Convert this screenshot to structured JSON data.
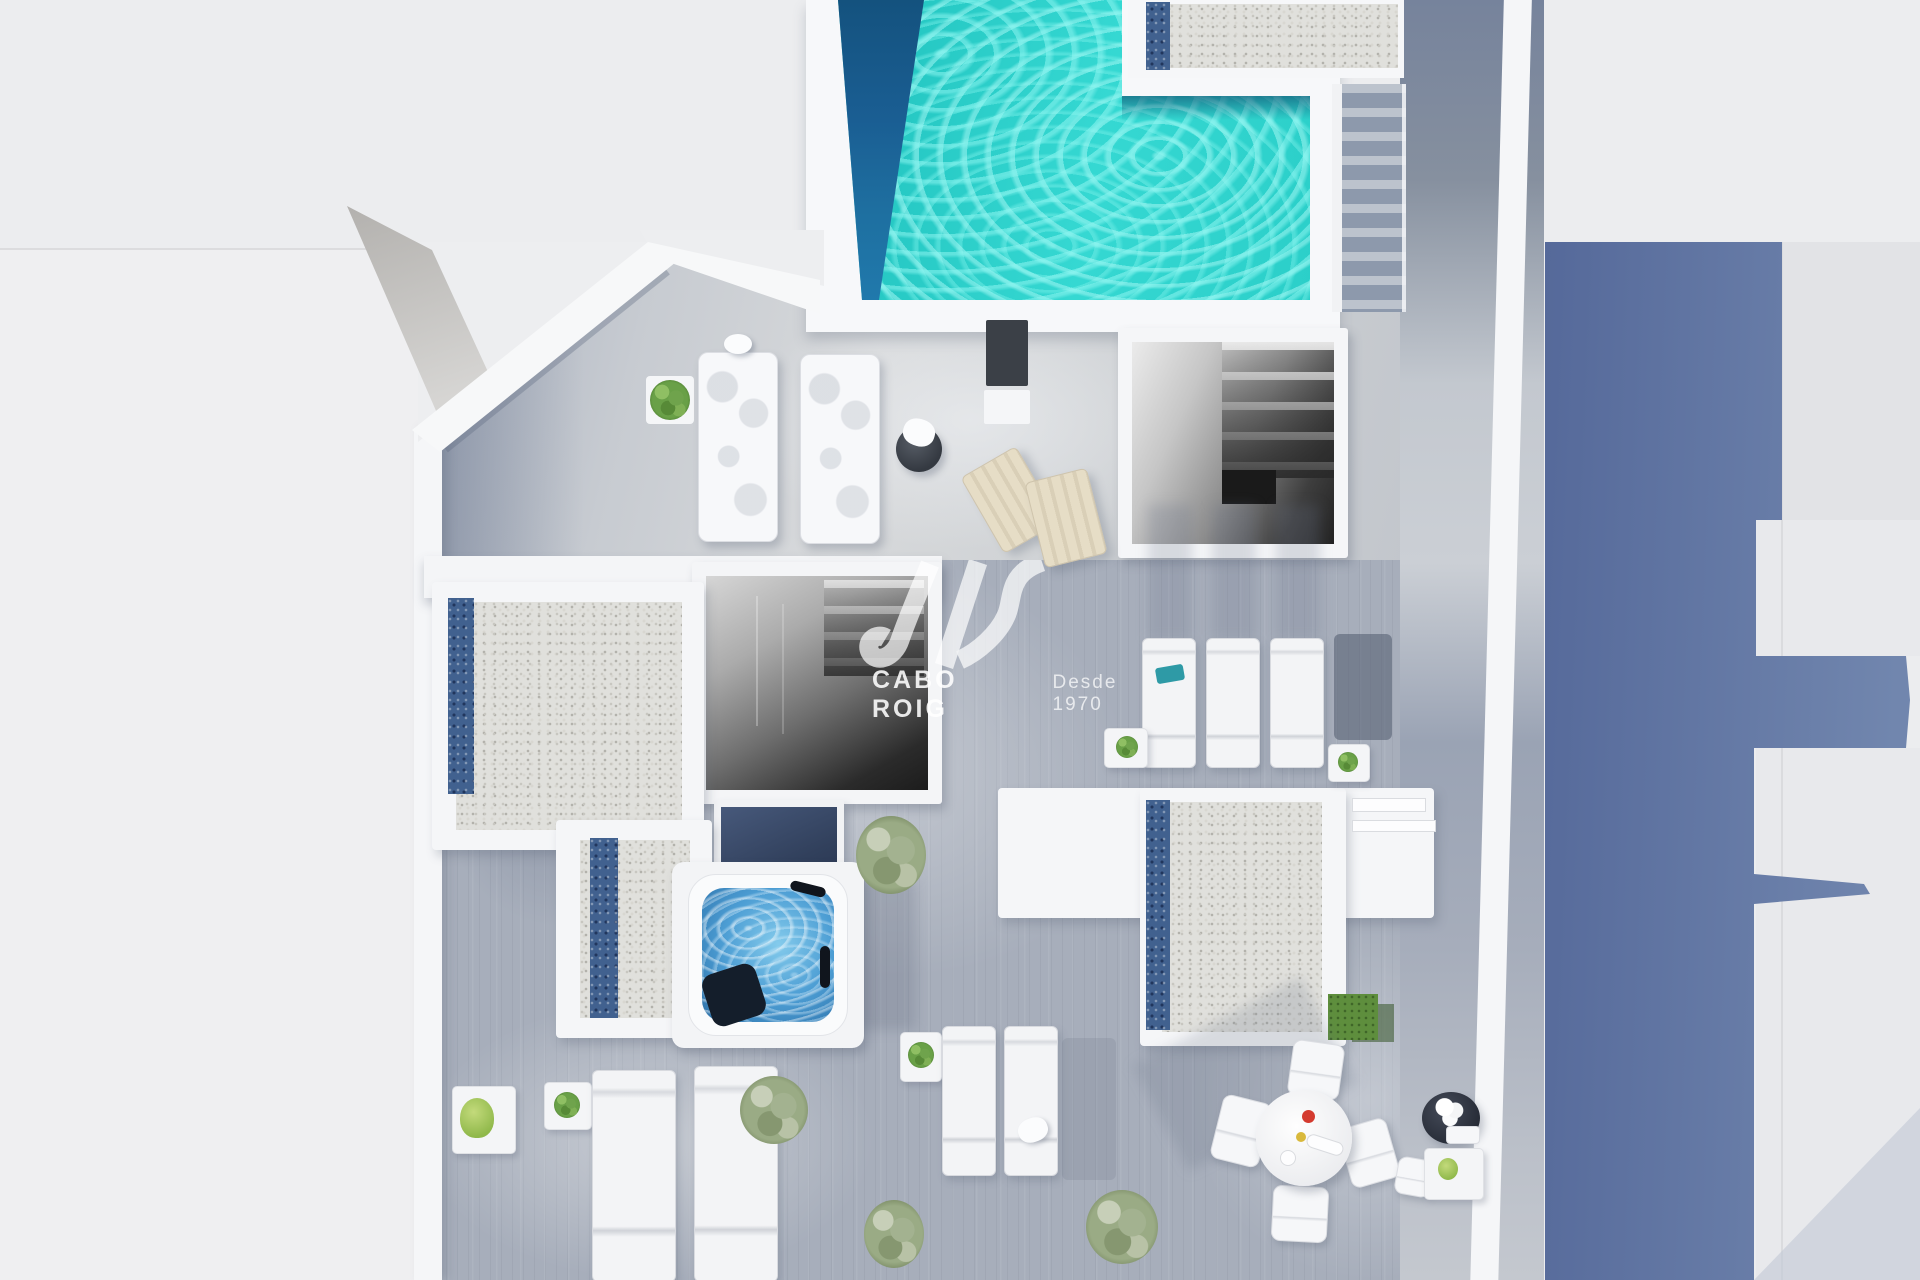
{
  "watermark": {
    "brand": "CABO ROIG",
    "tagline": "Desde 1970",
    "logo": "SIV wave monogram"
  },
  "colors": {
    "bg": "#ECEDEF",
    "structureWhite": "#F5F6F8",
    "deckLight": "#D6D8DA",
    "deckMid": "#A7AEBB",
    "deckDark": "#76839C",
    "poolTurquoise": "#2BCFC9",
    "poolDeep": "#1A5E93",
    "blueWall": "#5D74A3",
    "jacuzziWater": "#4D9ED4",
    "gravel": "#E0E0DC",
    "pebbleBlue": "#41618F",
    "foliage": "#6FA34C",
    "sageFoliage": "#A3B290",
    "grass": "#5E8E3D",
    "chairTan": "#E6DDC6",
    "accentRed": "#D43B2F"
  },
  "scene": {
    "type": "3d-aerial-render",
    "subject": "Penthouse roof terrace floor plan with swimming pool",
    "features": [
      "L-shaped swimming pool",
      "pool steps",
      "gravel sun platforms with blue pebble strips",
      "two stairwell openings",
      "glass skylight",
      "hot tub",
      "nine sun loungers",
      "two folding deck chairs",
      "round dining table with four chairs",
      "side tables with potted plants",
      "artificial grass patch",
      "planter with white flowers"
    ]
  }
}
